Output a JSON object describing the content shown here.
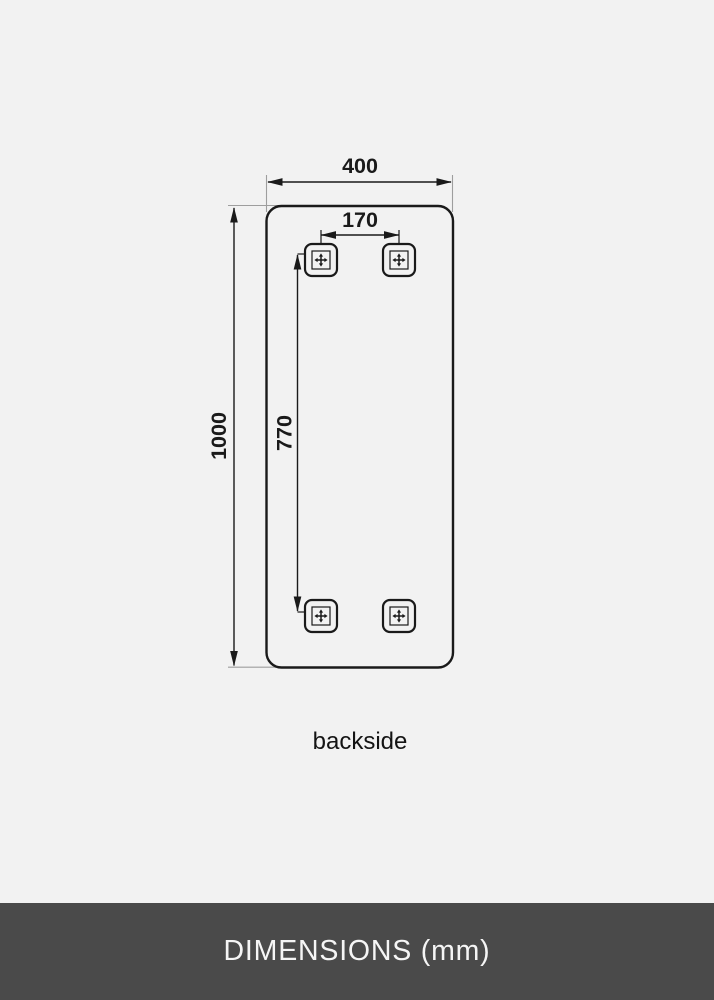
{
  "diagram": {
    "width_label": "400",
    "height_label": "1000",
    "bracket_spacing_horizontal_label": "170",
    "bracket_spacing_vertical_label": "770",
    "view_label": "backside"
  },
  "footer": {
    "title": "DIMENSIONS (mm)"
  },
  "colors": {
    "background": "#f2f2f2",
    "line": "#1a1a1a",
    "extension_line": "#9e9e9e",
    "footer_background": "#4a4a4a",
    "footer_text": "#f5f5f5"
  }
}
